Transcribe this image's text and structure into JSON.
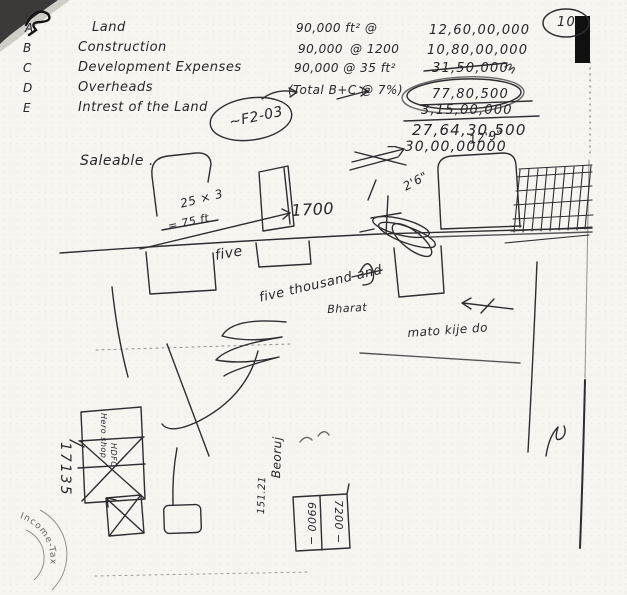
{
  "page": {
    "number": "10"
  },
  "ledger": {
    "rows": [
      {
        "letter": "A",
        "item": "Land",
        "qty": "90,000 ft² @",
        "rate": "",
        "amount": "12,60,00,000"
      },
      {
        "letter": "B",
        "item": "Construction",
        "qty": "90,000",
        "rate": "@ 1200",
        "amount": "10,80,00,000"
      },
      {
        "letter": "C",
        "item": "Development Expenses",
        "qty": "90,000 @ 35 ft²",
        "rate": "",
        "amount": "31,50,000"
      },
      {
        "letter": "D",
        "item": "Overheads",
        "qty": "(Total B+C @ 7%)",
        "rate": "",
        "amount": "77,80,500"
      },
      {
        "letter": "E",
        "item": "Intrest of the Land",
        "qty": "",
        "rate": "",
        "amount": "3,15,00,000"
      }
    ],
    "scribble": "~F2-03",
    "total": "27,64,30,500",
    "deduction": "− 30,00,00000",
    "saleable": "Saleable ."
  },
  "sketch": {
    "dims": {
      "d129": "12'9\"",
      "d26": "2'6\""
    },
    "calc": {
      "a": "25 × 3",
      "b": "= 75 ft",
      "c": "1700"
    },
    "notes": {
      "five": "five",
      "five_thousand": "five thousand and",
      "bharat": "Bharat",
      "mato": "mato kije do"
    },
    "rotated": {
      "beoruj": "Beoruj",
      "n15121": "151.21",
      "n17135": "17135",
      "box_left": "6900 −",
      "box_right": "7200 −",
      "hero": "Hero shop",
      "hdfc": "HDFC"
    }
  },
  "stamp": {
    "text": "Income-Tax"
  }
}
